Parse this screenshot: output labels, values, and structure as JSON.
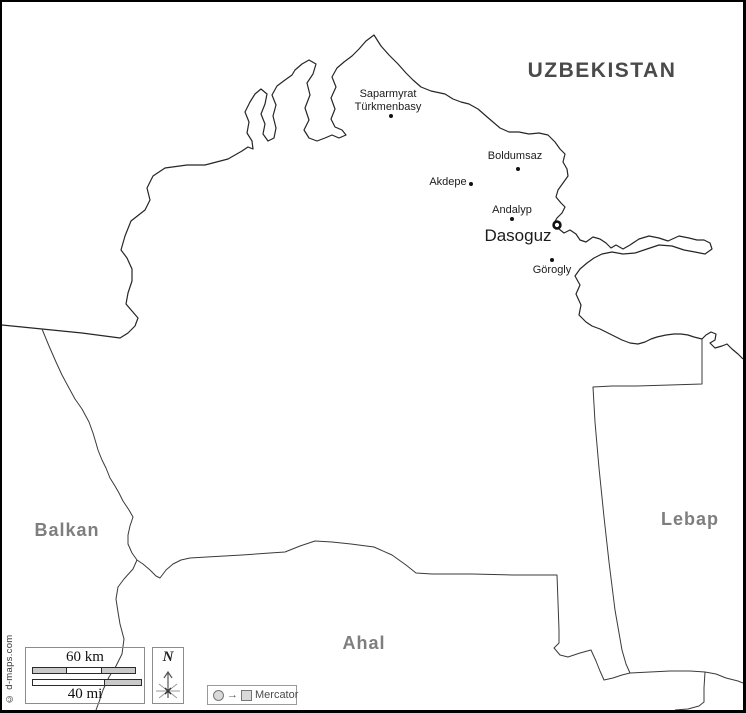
{
  "country_label": {
    "text": "UZBEKISTAN"
  },
  "province_labels": {
    "balkan": "Balkan",
    "lebap": "Lebap",
    "ahal": "Ahal"
  },
  "cities": {
    "saparmyrat_turkmenbasy": {
      "line1": "Saparmyrat",
      "line2": "Türkmenbasy"
    },
    "boldumsaz": {
      "label": "Boldumsaz"
    },
    "akdepe": {
      "label": "Akdepe"
    },
    "andalyp": {
      "label": "Andalyp"
    },
    "gorogly": {
      "label": "Görogly"
    }
  },
  "capital": {
    "label": "Dasoguz"
  },
  "scale_bar": {
    "km_label": "60 km",
    "mi_label": "40 mi"
  },
  "compass": {
    "north_label": "N"
  },
  "legend": {
    "projection_label": "Mercator"
  },
  "credit": {
    "text": "© d-maps.com"
  },
  "colors": {
    "frame": "#000000",
    "border_line": "#262626",
    "province_line": "#3a3a3a",
    "country_label": "#4a4a4a",
    "province_label": "#7e7e7e",
    "city_label": "#1c1c1c",
    "scale_bar_fill": "#c9c9c9",
    "box_border": "#8c8c8c"
  }
}
